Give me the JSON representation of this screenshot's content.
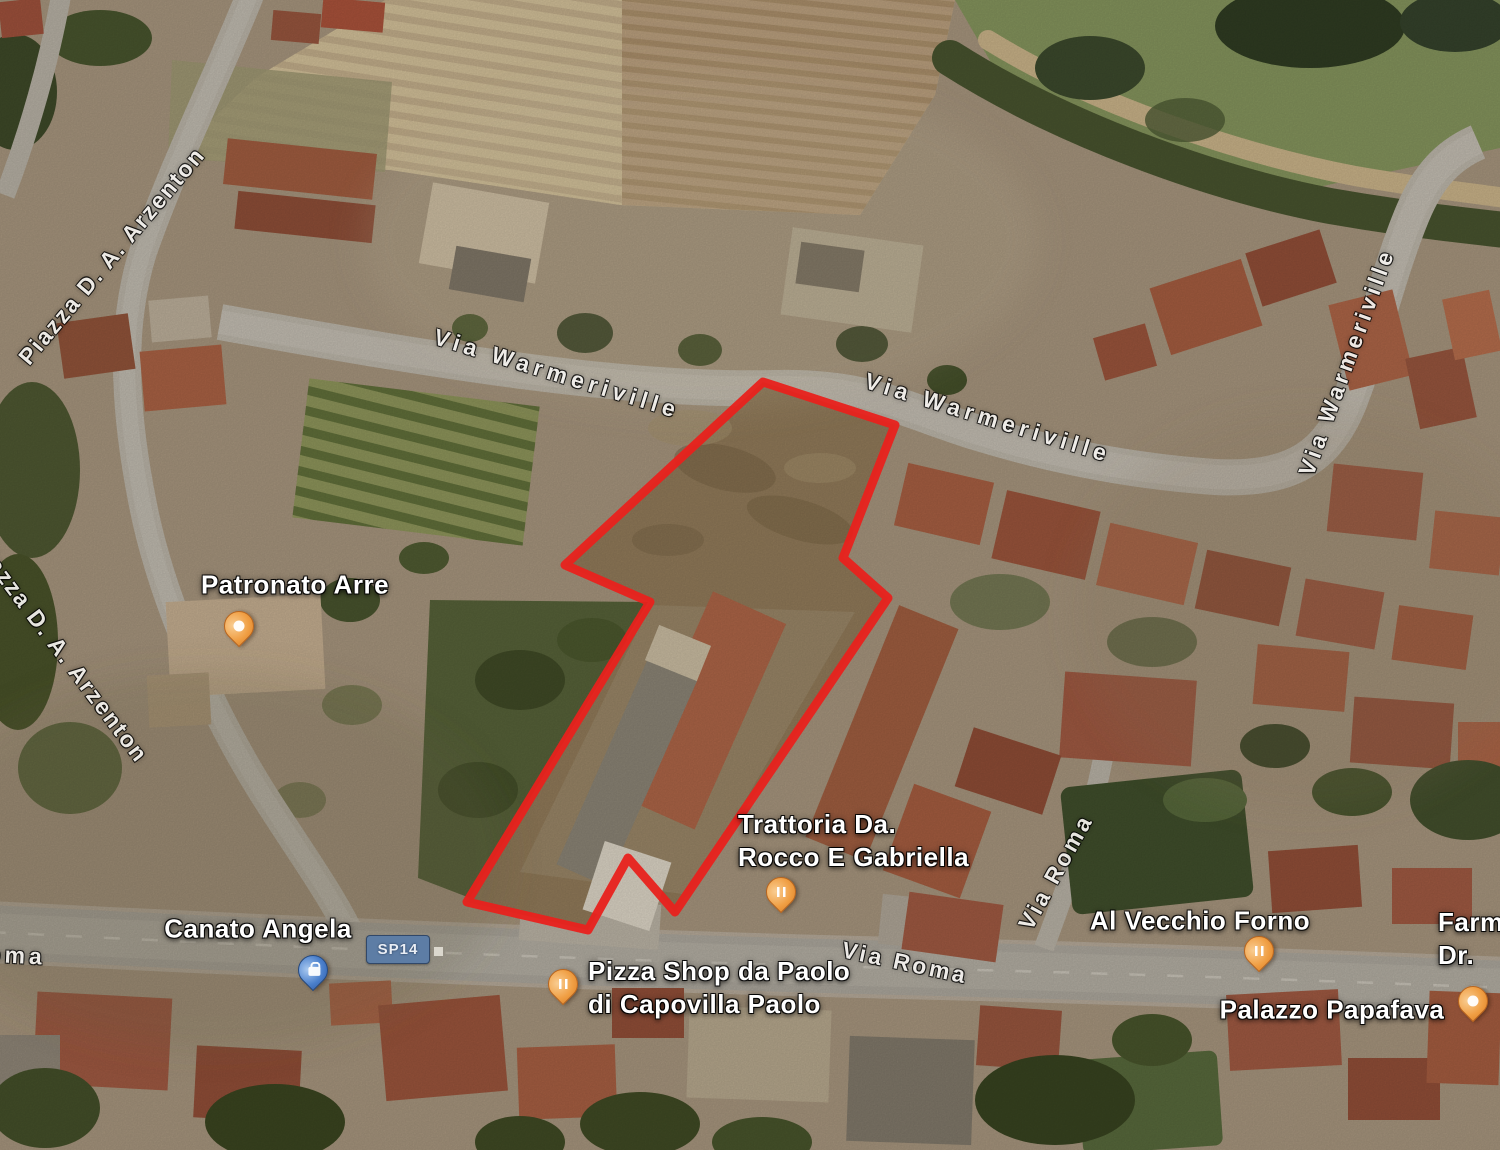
{
  "map": {
    "view": "satellite",
    "parcel_outline": {
      "color": "#e8211c",
      "stroke_width": 9,
      "points": "763,382 895,425 843,558 888,598 675,912 628,858 588,930 467,902 650,602 565,565"
    },
    "road_shield": {
      "text": "SP14"
    },
    "street_labels": [
      {
        "text": "Via Warmeriville",
        "x": 557,
        "y": 374,
        "rot": 17,
        "ls": 5
      },
      {
        "text": "Via Warmeriville",
        "x": 988,
        "y": 418,
        "rot": 17,
        "ls": 5
      },
      {
        "text": "Via Warmeriville",
        "x": 1347,
        "y": 362,
        "rot": -70,
        "ls": 4
      },
      {
        "text": "Piazza D. A. Arzenton",
        "x": 112,
        "y": 256,
        "rot": -50,
        "ls": 2
      },
      {
        "text": "Piazza D. A. Arzenton",
        "x": 60,
        "y": 650,
        "rot": 53,
        "ls": 2
      },
      {
        "text": "Via Roma",
        "x": 1056,
        "y": 872,
        "rot": -61,
        "ls": 3
      },
      {
        "text": "Via Roma",
        "x": 905,
        "y": 963,
        "rot": 12,
        "ls": 3
      },
      {
        "text": "Roma",
        "x": -34,
        "y": 953,
        "rot": 3,
        "ls": 4,
        "align": "left"
      }
    ],
    "poi_labels": [
      {
        "id": "patronato-arre",
        "lines": [
          "Patronato Arre"
        ],
        "x": 295,
        "y": 585,
        "align": "center"
      },
      {
        "id": "trattoria-rocco-gabriella",
        "lines": [
          "Trattoria Da.",
          "Rocco E Gabriella"
        ],
        "x": 738,
        "y": 808,
        "align": "left"
      },
      {
        "id": "canato-angela",
        "lines": [
          "Canato Angela"
        ],
        "x": 258,
        "y": 929,
        "align": "center"
      },
      {
        "id": "pizza-shop-capovilla",
        "lines": [
          "Pizza Shop da Paolo",
          "di Capovilla Paolo"
        ],
        "x": 588,
        "y": 955,
        "align": "left"
      },
      {
        "id": "al-vecchio-forno",
        "lines": [
          "Al Vecchio Forno"
        ],
        "x": 1200,
        "y": 921,
        "align": "center"
      },
      {
        "id": "palazzo-papafava",
        "lines": [
          "Palazzo Papafava"
        ],
        "x": 1332,
        "y": 1010,
        "align": "center"
      },
      {
        "id": "farmacia-dr",
        "lines": [
          "Farmacia",
          "Dr."
        ],
        "x": 1438,
        "y": 906,
        "align": "left"
      }
    ],
    "pins": [
      {
        "id": "patronato-arre-pin",
        "type": "landmark",
        "color": "orange",
        "x": 238,
        "y": 647
      },
      {
        "id": "trattoria-pin",
        "type": "restaurant",
        "color": "orange",
        "x": 780,
        "y": 913
      },
      {
        "id": "canato-angela-pin",
        "type": "shopping",
        "color": "blue",
        "x": 312,
        "y": 991
      },
      {
        "id": "pizza-shop-pin",
        "type": "restaurant",
        "color": "orange",
        "x": 562,
        "y": 1005
      },
      {
        "id": "al-vecchio-forno-pin",
        "type": "restaurant",
        "color": "orange",
        "x": 1258,
        "y": 972
      },
      {
        "id": "palazzo-papafava-pin",
        "type": "landmark",
        "color": "orange",
        "x": 1472,
        "y": 1022
      }
    ]
  }
}
